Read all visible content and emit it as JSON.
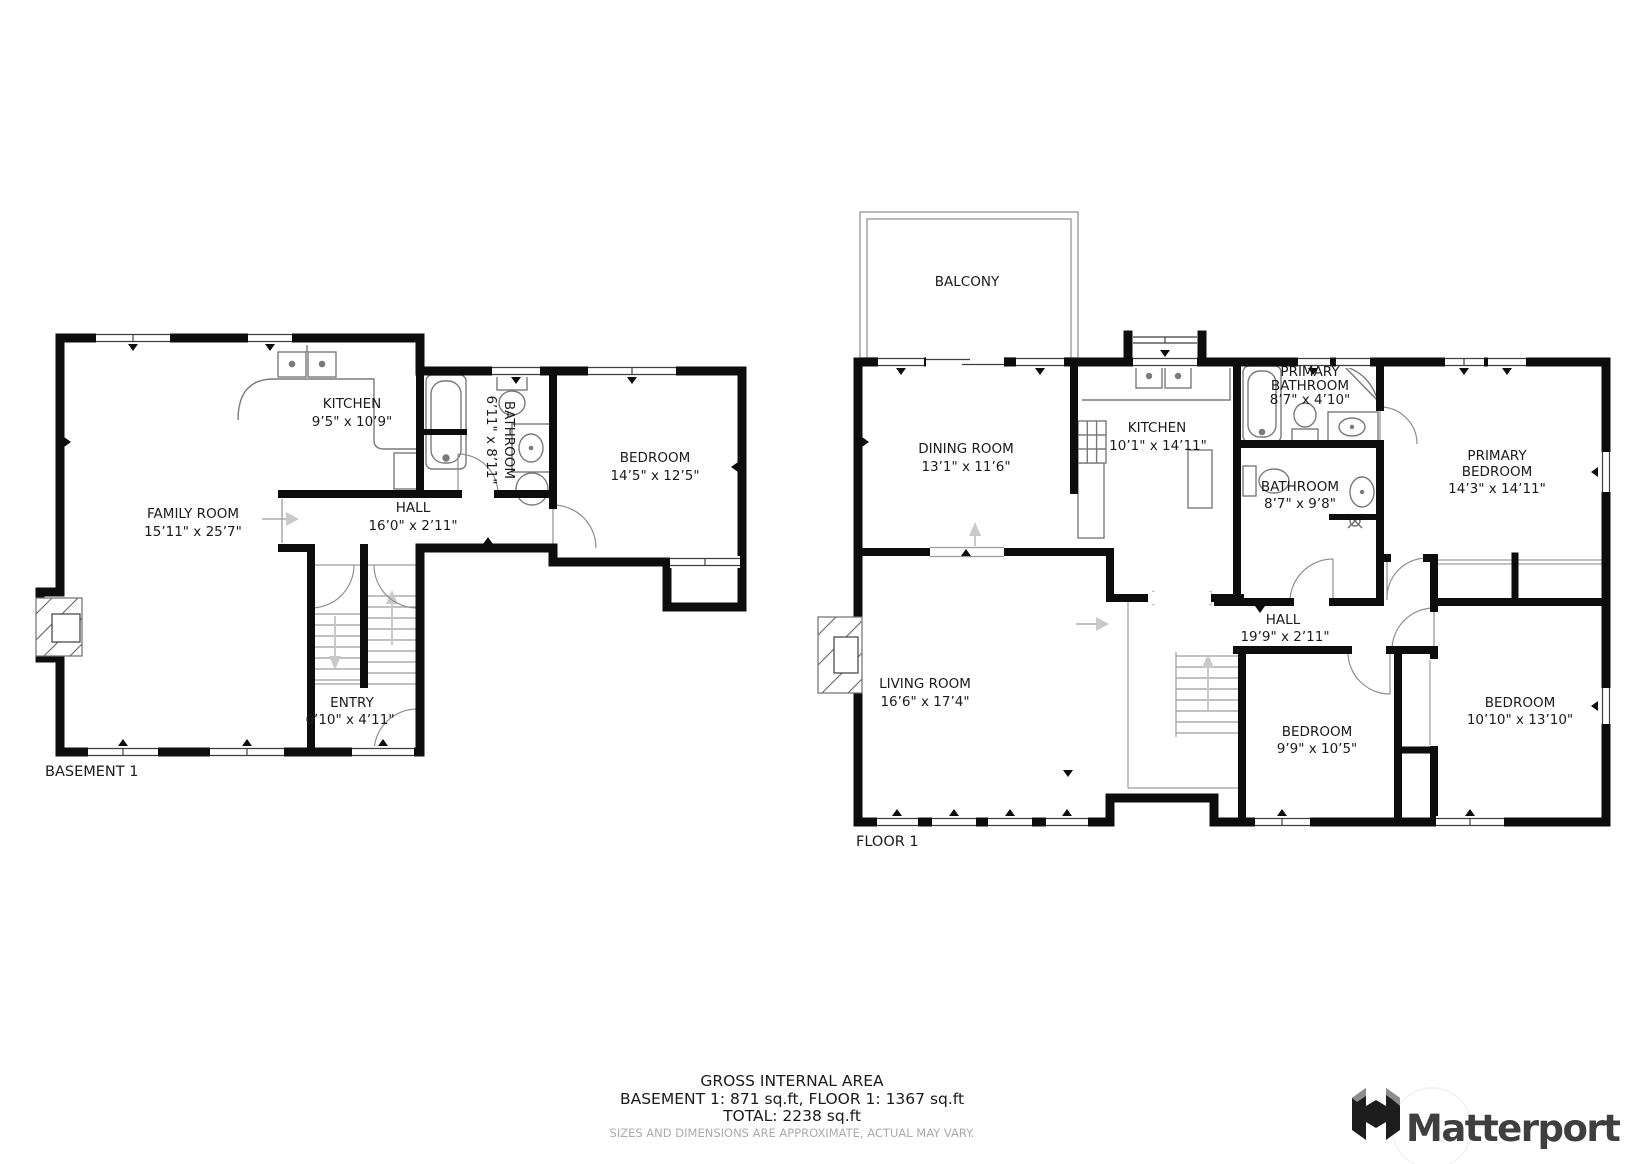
{
  "basement": {
    "label": "BASEMENT 1",
    "rooms": [
      {
        "name": "FAMILY ROOM",
        "dims": "15’11\" x 25’7\""
      },
      {
        "name": "KITCHEN",
        "dims": "9’5\" x 10’9\""
      },
      {
        "name": "BATHROOM",
        "dims": "6’11\" x 8’11\""
      },
      {
        "name": "BEDROOM",
        "dims": "14’5\" x 12’5\""
      },
      {
        "name": "HALL",
        "dims": "16’0\" x 2’11\""
      },
      {
        "name": "ENTRY",
        "dims": "6’10\" x 4’11\""
      }
    ]
  },
  "floor1": {
    "label": "FLOOR 1",
    "rooms": [
      {
        "name": "BALCONY"
      },
      {
        "name": "DINING ROOM",
        "dims": "13’1\" x 11’6\""
      },
      {
        "name": "KITCHEN",
        "dims": "10’1\" x 14’11\""
      },
      {
        "name1": "PRIMARY",
        "name2": "BATHROOM",
        "dims": "8’7\" x 4’10\""
      },
      {
        "name": "BATHROOM",
        "dims": "8’7\" x 9’8\""
      },
      {
        "name1": "PRIMARY",
        "name2": "BEDROOM",
        "dims": "14’3\" x 14’11\""
      },
      {
        "name": "LIVING ROOM",
        "dims": "16’6\" x 17’4\""
      },
      {
        "name": "HALL",
        "dims": "19’9\" x 2’11\""
      },
      {
        "name": "BEDROOM",
        "dims": "9’9\" x 10’5\""
      },
      {
        "name": "BEDROOM",
        "dims": "10’10\" x 13’10\""
      }
    ]
  },
  "summary": {
    "title": "GROSS INTERNAL AREA",
    "areas": "BASEMENT 1: 871 sq.ft, FLOOR 1: 1367 sq.ft",
    "total": "TOTAL: 2238 sq.ft",
    "disclaimer": "SIZES AND DIMENSIONS ARE APPROXIMATE, ACTUAL MAY VARY."
  },
  "branding": {
    "name": "Matterport"
  },
  "colors": {
    "wall": "#0d0d0d",
    "thin_line": "#9c9c9c",
    "fixture_line": "#7a7a7a",
    "arrow_gray": "#c9c9c9",
    "label_text": "#1b1b1b",
    "disclaimer_text": "#ababab",
    "logo_text": "#3f3f3f"
  }
}
